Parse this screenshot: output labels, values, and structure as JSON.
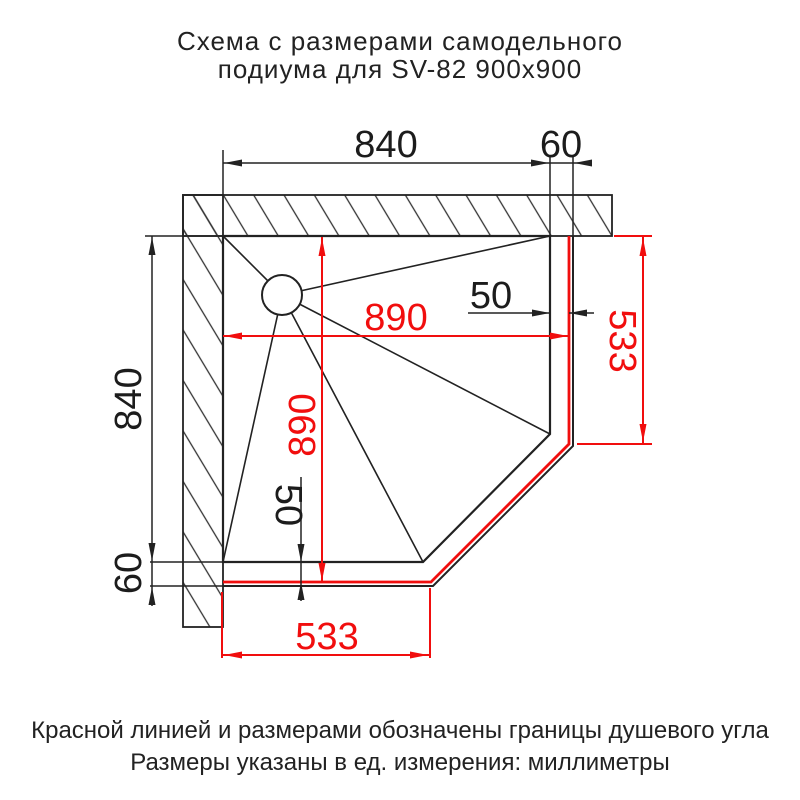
{
  "title": {
    "line1": "Схема с размерами самодельного",
    "line2": "подиума для SV-82 900x900"
  },
  "footnotes": {
    "line1": "Красной линией и размерами обозначены границы душевого угла",
    "line2": "Размеры указаны в ед. измерения: миллиметры"
  },
  "units": "миллиметры",
  "colors": {
    "boundary_red": "#f10e0e",
    "line_black": "#222222"
  },
  "dims": {
    "top_width": "840",
    "top_offset": "60",
    "left_height": "840",
    "left_offset": "60",
    "gap_right": "50",
    "gap_bottom": "50",
    "red_width": "890",
    "red_height": "890",
    "red_edge_right": "533",
    "red_edge_bottom": "533"
  }
}
